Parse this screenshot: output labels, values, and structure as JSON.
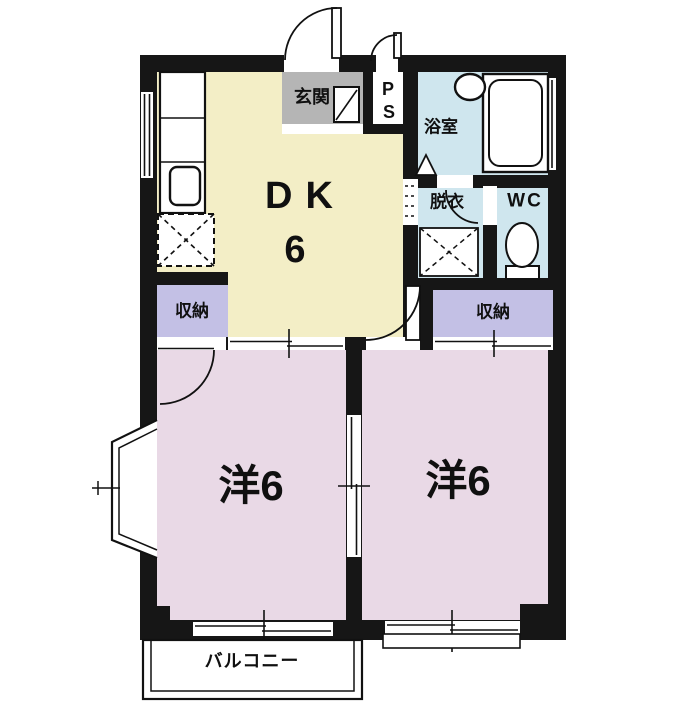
{
  "floorplan": {
    "dk": {
      "label": "DK",
      "size": "6"
    },
    "room_left": {
      "label": "洋6"
    },
    "room_right": {
      "label": "洋6"
    },
    "genkan": {
      "label": "玄関"
    },
    "ps": {
      "p": "P",
      "s": "S"
    },
    "bathroom": {
      "label": "浴室"
    },
    "dressing": {
      "label": "脱衣"
    },
    "wc": {
      "label": "WC"
    },
    "storage_left": {
      "label": "収納"
    },
    "storage_right": {
      "label": "収納"
    },
    "balcony": {
      "label": "バルコニー"
    },
    "colors": {
      "wall": "#161616",
      "dk_fill": "#f3eec6",
      "room_fill": "#e9d9e6",
      "storage_fill": "#c3c0e5",
      "wet_fill": "#cfe6ee",
      "genkan_fill": "#b5b5b5",
      "white": "#ffffff"
    }
  }
}
